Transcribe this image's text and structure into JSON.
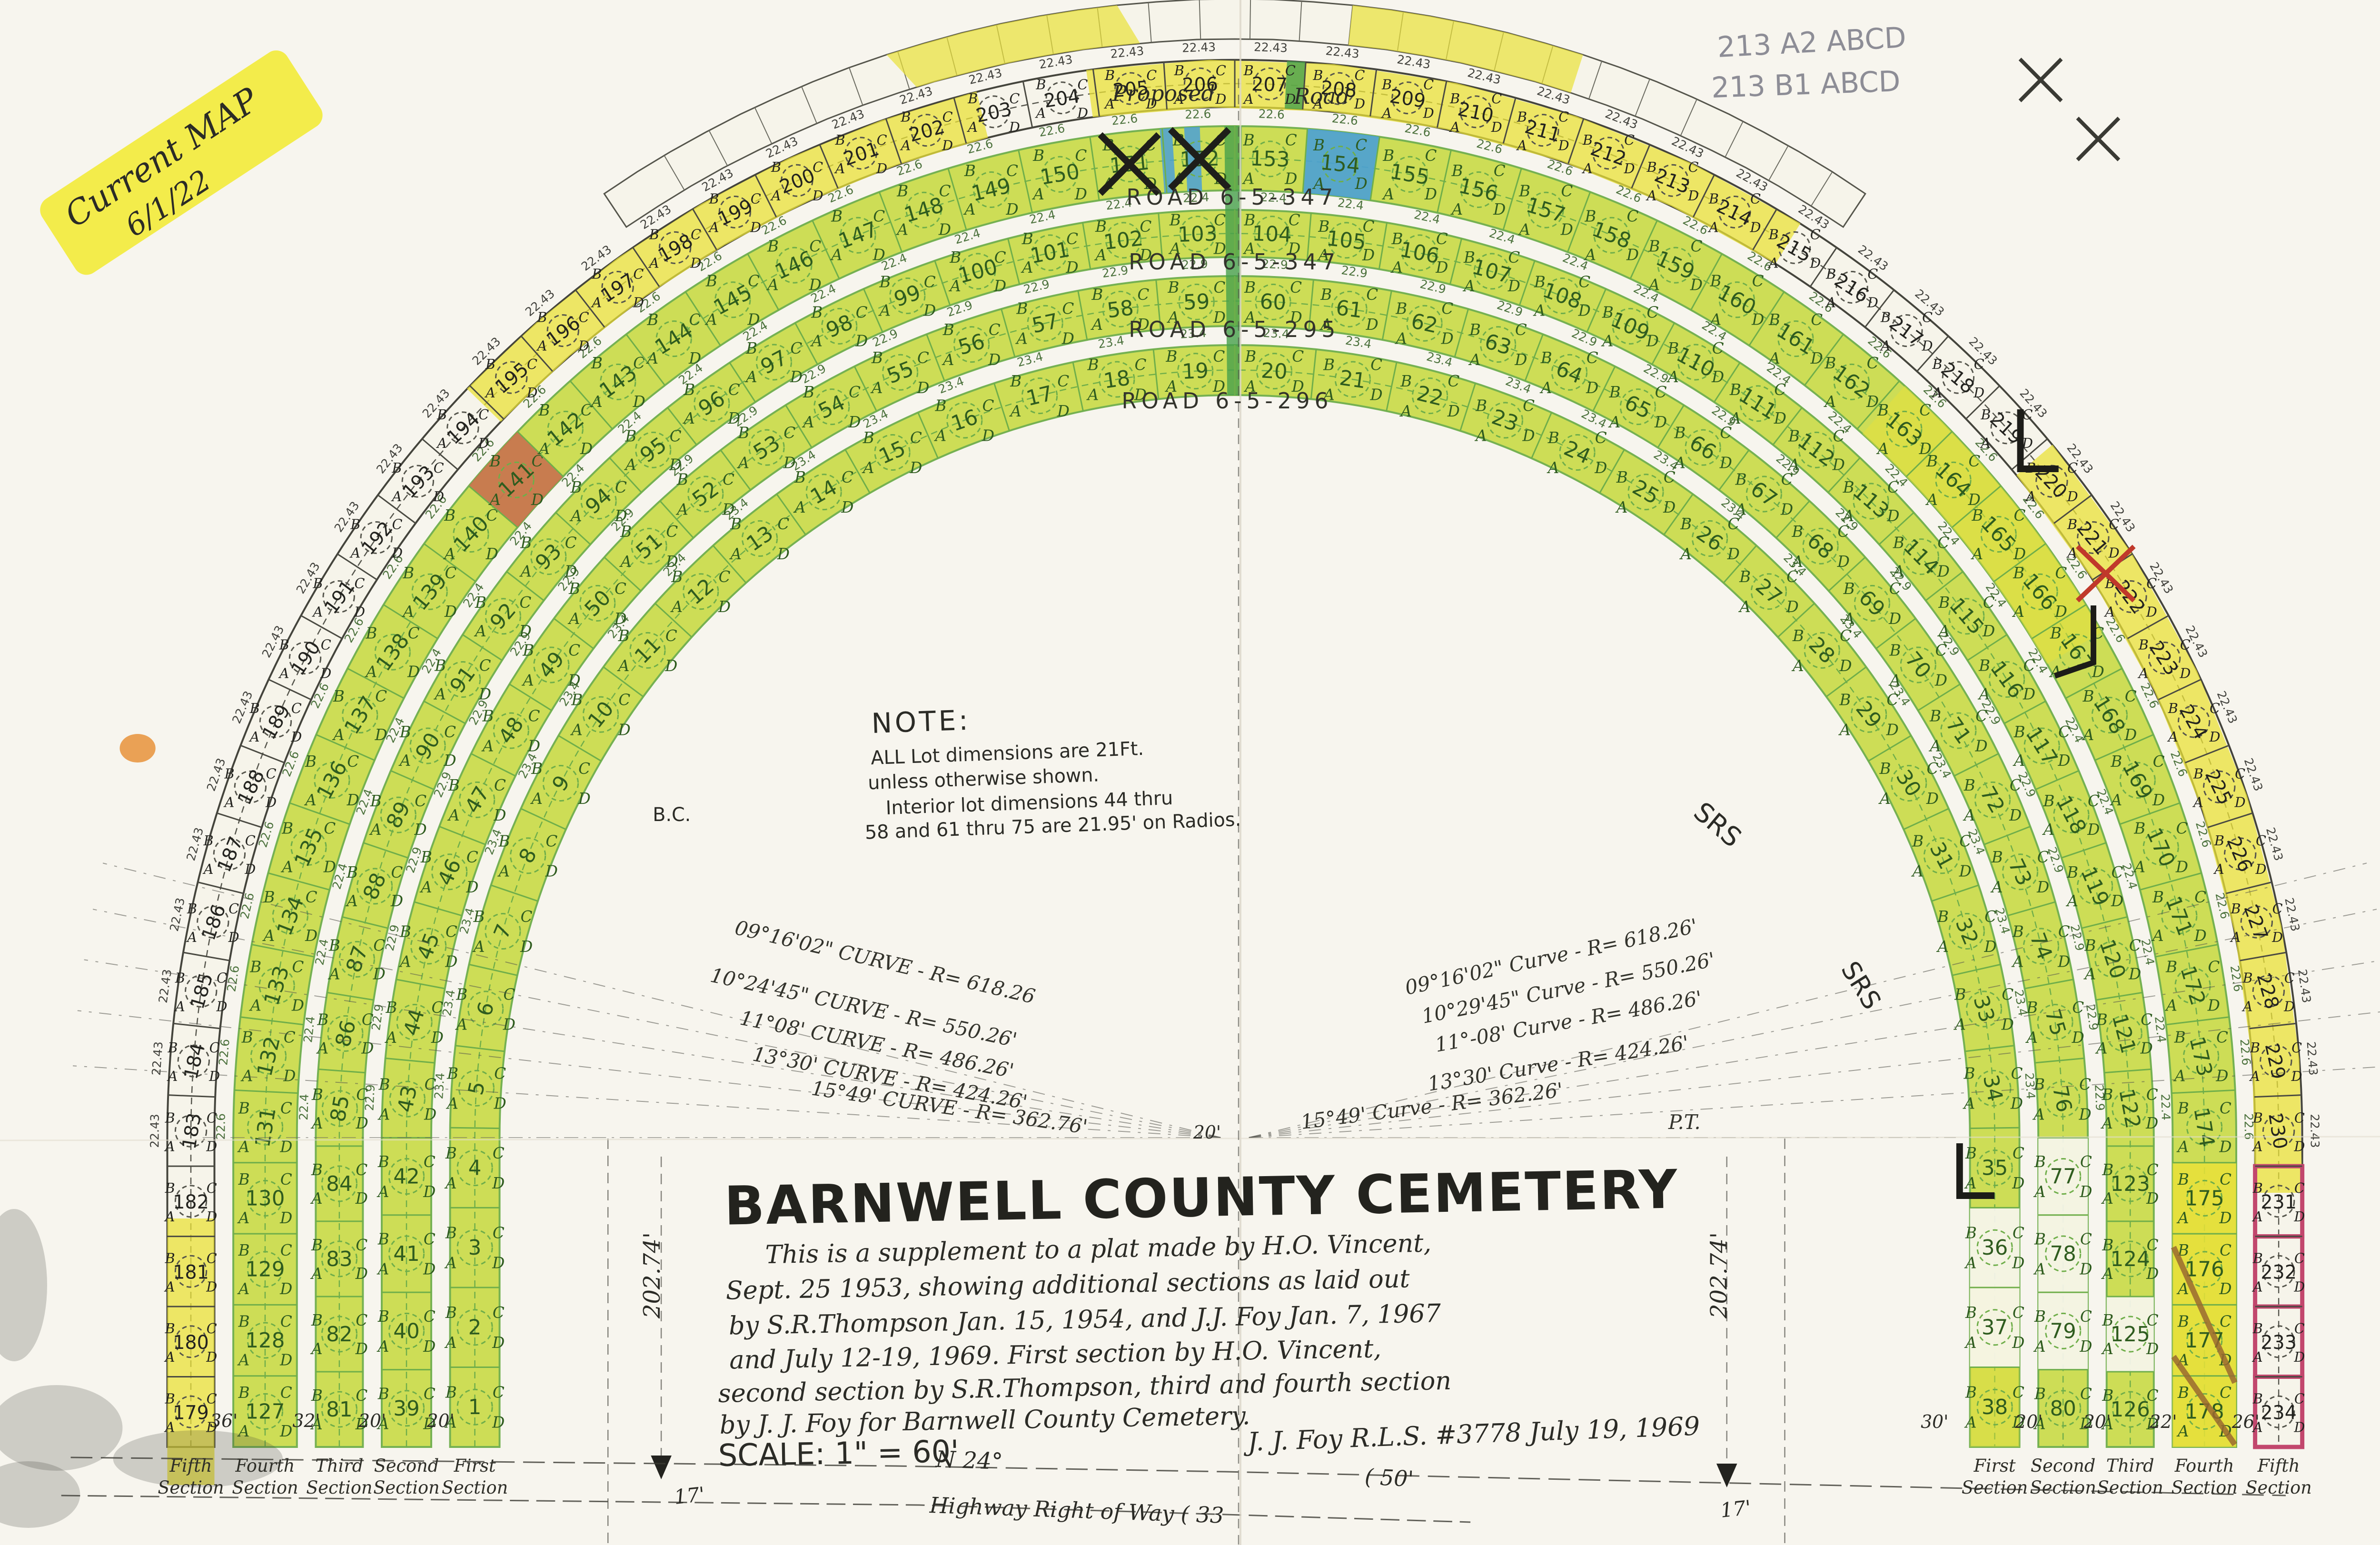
{
  "stickers": {
    "current_map_line1": "Current MAP",
    "current_map_line2": "6/1/22",
    "pencil_note_1": "213 A2 ABCD",
    "pencil_note_2": "213 B1 ABCD"
  },
  "roads": {
    "proposed": "Proposed",
    "road": "Road",
    "r1": "ROAD   6-5-347",
    "r2": "ROAD   6-5-347",
    "r3": "ROAD   6-5-295",
    "r4": "ROAD   6-5-296",
    "srs": "SRS"
  },
  "curves_left": [
    "09°16'02\" CURVE - R= 618.26",
    "10°24'45\" CURVE - R= 550.26'",
    "11°08' CURVE - R= 486.26'",
    "13°30' CURVE - R= 424.26'",
    "15°49' CURVE - R= 362.76'"
  ],
  "curves_right": [
    "09°16'02\" Curve - R= 618.26'",
    "10°29'45\" Curve - R= 550.26'",
    "11°-08' Curve - R= 486.26'",
    "13°30' Curve - R= 424.26'",
    "15°49' Curve - R= 362.26'"
  ],
  "note": {
    "heading": "NOTE:",
    "line1": "ALL Lot dimensions are 21Ft.",
    "line2": "unless otherwise shown.",
    "line3": "Interior lot dimensions 44 thru",
    "line4": "58 and 61 thru 75 are 21.95' on Radios."
  },
  "title_block": {
    "title": "BARNWELL COUNTY CEMETERY",
    "line1": "This is a supplement to a plat made by H.O. Vincent,",
    "line2": "Sept. 25 1953, showing additional sections as laid out",
    "line3": "by S.R.Thompson Jan. 15, 1954, and J.J. Foy Jan. 7, 1967",
    "line4": "and July 12-19, 1969.  First section by H.O. Vincent,",
    "line5": "second section by S.R.Thompson, third and fourth section",
    "line6": "by  J. J. Foy  for  Barnwell  County  Cemetery.",
    "scale": "SCALE: 1\" = 60'",
    "signature": "J. J. Foy  R.L.S. #3778  July 19, 1969"
  },
  "footer": {
    "bearing": "N 24°",
    "fifty": "( 50'",
    "highway": "Highway  Right  of  Way    ( 33",
    "seventeen_left": "17'",
    "seventeen_right": "17'"
  },
  "dims": {
    "left_202": "202.74'",
    "right_202": "202.74'",
    "bc": "B.C.",
    "pt": "P.T.",
    "vertex": "20'",
    "left_gaps": [
      "36'",
      "32'",
      "20'",
      "20'"
    ],
    "right_gaps": [
      "30'",
      "20'",
      "20'",
      "22'",
      "26'"
    ]
  },
  "bands": [
    {
      "name": "First Section",
      "start": 1,
      "end": 38,
      "dim": "23.4"
    },
    {
      "name": "Second Section",
      "start": 39,
      "end": 80,
      "dim": "22.9"
    },
    {
      "name": "Third Section",
      "start": 81,
      "end": 126,
      "dim": "22.4"
    },
    {
      "name": "Fourth Section",
      "start": 127,
      "end": 178,
      "dim": "22.6"
    },
    {
      "name": "Fifth Section",
      "start": 179,
      "end": 234,
      "dim": "22.43"
    }
  ],
  "quadrant_letters": {
    "ul": "B",
    "ur": "C",
    "ll": "A",
    "lr": "D"
  },
  "highlights": {
    "blue_lots": [
      154
    ],
    "x_lots": [
      151,
      152
    ],
    "red_lots": [
      141
    ],
    "yellow_lots": [
      175,
      176,
      177,
      178
    ],
    "white_lots": [
      36,
      37,
      77,
      78,
      79,
      125
    ],
    "pink_outline_lots": [
      231,
      232,
      233,
      234
    ]
  },
  "colors": {
    "paper": "#f7f5ee",
    "band_green": "#cbdc4e",
    "band_white": "#f6f4ea",
    "ink_green": "#2f5c1f",
    "line_green": "#6fae4a",
    "highlight_yellow": "#e9e138",
    "blue": "#4aa0d6",
    "red_lot": "#c8714f",
    "pink": "#c2476d",
    "stripe_green": "#46a04b",
    "ink": "#2b2b26"
  }
}
